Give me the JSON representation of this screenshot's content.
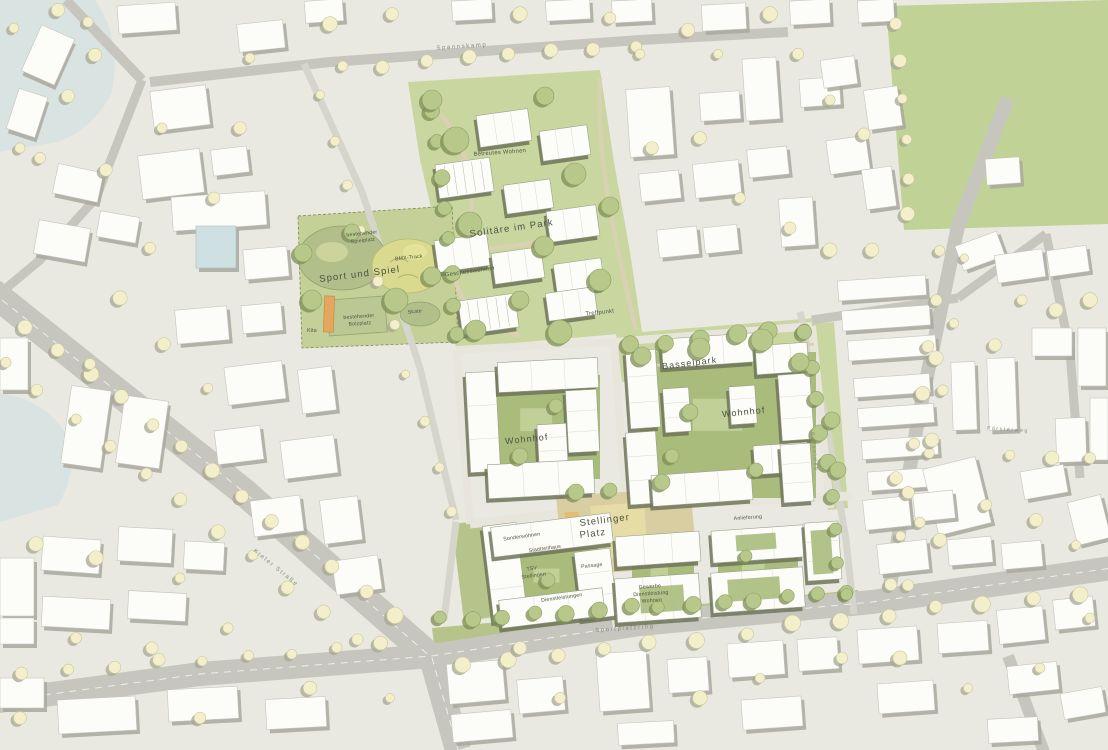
{
  "area_labels": {
    "solitaere_im_park": "Solitäre im Park",
    "sport_und_spiel": "Sport und Spiel",
    "basselpark": "Basselpark",
    "wohnhof_west": "Wohnhof",
    "wohnhof_ost": "Wohnhof",
    "stellinger_platz_line1": "Stellinger",
    "stellinger_platz_line2": "Platz"
  },
  "site_labels": {
    "betreutes_wohnen": "Betreutes Wohnen",
    "geschosswohnen": "Geschosswohnen",
    "treffpunkt": "Treffpunkt",
    "bestehender_spielplatz_line1": "bestehender",
    "bestehender_spielplatz_line2": "Spielplatz",
    "bmx_track": "BMX-Track",
    "skate": "Skate",
    "bestehender_bolzplatz_line1": "bestehender",
    "bestehender_bolzplatz_line2": "Bolzplatz",
    "kita": "Kita",
    "sonderwohnen": "Sonderwohnen",
    "stadtteilhaus": "Stadtteilhaus",
    "tsv_line1": "TSV",
    "tsv_line2": "Stellingen",
    "dienstleistungen": "Dienstleistungen",
    "passage": "Passage",
    "gewerbe_line1": "Gewerbe",
    "gewerbe_line2": "Dienstleistung",
    "gewerbe_line3": "Wohnen",
    "anlieferung": "Anlieferung"
  },
  "street_labels": {
    "spannskamp": "Spannskamp",
    "kieler_strasse": "Kieler Straße",
    "sportplatzring": "Sportplatzring",
    "basselweg": "Basselweg",
    "foersterweg": "Försterweg"
  },
  "colors": {
    "background": "#eae9e1",
    "water": "#d9e4e2",
    "road": "#c6c6bf",
    "road_minor": "#d6d5cb",
    "street_internal": "#e8e6dc",
    "park_green": "#c9d6a0",
    "sport_green": "#c4d097",
    "court_green": "#a9bc7c",
    "verge_green": "#b6c48b",
    "field_green": "#c0d295",
    "plaza_tan": "#d9cda2",
    "plaza_light": "#e6dca6",
    "accent_orange": "#e2bd72",
    "building_white": "#fcfcf9",
    "building_blue": "#cfe0e2",
    "shadow_gray": "#a9a89d",
    "shadow_olive": "#6e7459",
    "tree_pale": "#f2efca",
    "tree_green": "#b7c88a",
    "label_dark": "#4c5342",
    "label_street": "#8b8b82"
  }
}
